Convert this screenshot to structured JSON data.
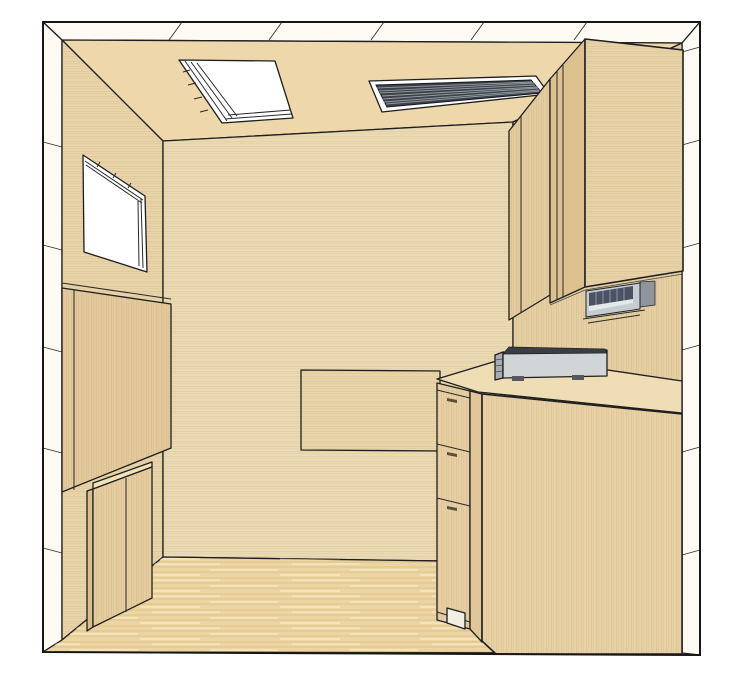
{
  "scene": {
    "style": "3d-line-render",
    "description": "Cutaway perspective rendering of a small wood-paneled room",
    "objects": [
      {
        "name": "shell",
        "label": "White cutaway wall shell with panel seams"
      },
      {
        "name": "ceiling",
        "label": "Tan wood ceiling"
      },
      {
        "name": "skylight",
        "label": "Skylight with stepped light well"
      },
      {
        "name": "ceiling-vent",
        "label": "Dark louvered ceiling air vent"
      },
      {
        "name": "back-wall",
        "label": "Wood back wall"
      },
      {
        "name": "left-wall",
        "label": "Wood left wall"
      },
      {
        "name": "right-wall",
        "label": "Wood right wall"
      },
      {
        "name": "window",
        "label": "Window opening on left wall"
      },
      {
        "name": "left-wall-panel",
        "label": "Raised wood panel on left wall"
      },
      {
        "name": "left-low-cabinet",
        "label": "Low two-door cabinet at left wall"
      },
      {
        "name": "wall-table",
        "label": "Panel / table front against back wall"
      },
      {
        "name": "upper-cabinet-small",
        "label": "Corner upper cabinet"
      },
      {
        "name": "upper-cabinet-large",
        "label": "Large upper wall cabinet"
      },
      {
        "name": "under-cabinet-appliance",
        "label": "Under-cabinet appliance"
      },
      {
        "name": "counter-device",
        "label": "Flat silver device on countertop"
      },
      {
        "name": "countertop",
        "label": "Wood countertop along right wall"
      },
      {
        "name": "drawer-unit",
        "label": "Base cabinet drawer stack (3 drawers)"
      },
      {
        "name": "base-cabinet-panel",
        "label": "Base cabinet end panel"
      },
      {
        "name": "floor",
        "label": "Light wood plank floor"
      }
    ]
  },
  "colors": {
    "page_bg": "#ffffff",
    "outline": "#1c1c1c",
    "shell_white": "#fdfaf4",
    "ceiling": "#edd7ab",
    "back_wall": "#ebdbb4",
    "left_wall": "#e9d4aa",
    "right_wall": "#e5cfa3",
    "left_panel": "#e3ca9c",
    "panel_edge": "#d9bd8c",
    "low_cabinet": "#e5cda0",
    "low_cabinet_top": "#f1e2bd",
    "wall_table": "#e9d5aa",
    "small_upper_cab": "#e3cc9f",
    "big_cab_side": "#ddc28f",
    "big_cab_front": "#e8d2a7",
    "counter": "#efddb5",
    "end_panel": "#e8d1a5",
    "drawer_front": "#e6cfa3",
    "stile": "#e0c79a",
    "floor": "#ecd5a2",
    "fixture_white": "#ffffff",
    "vent_dark": "#3e434a",
    "vent_slat": "#959ca3",
    "appliance_body": "#c7ccd1",
    "appliance_dark": "#4a5263",
    "appliance_band": "#e6e9ec",
    "appliance_side": "#8f959b",
    "device_body": "#d2d5d8",
    "device_top": "#3a3e42",
    "device_side": "#a7adb3",
    "device_feet": "#55585c",
    "handle": "#5e5036",
    "toe_kick": "#f3eee4"
  }
}
